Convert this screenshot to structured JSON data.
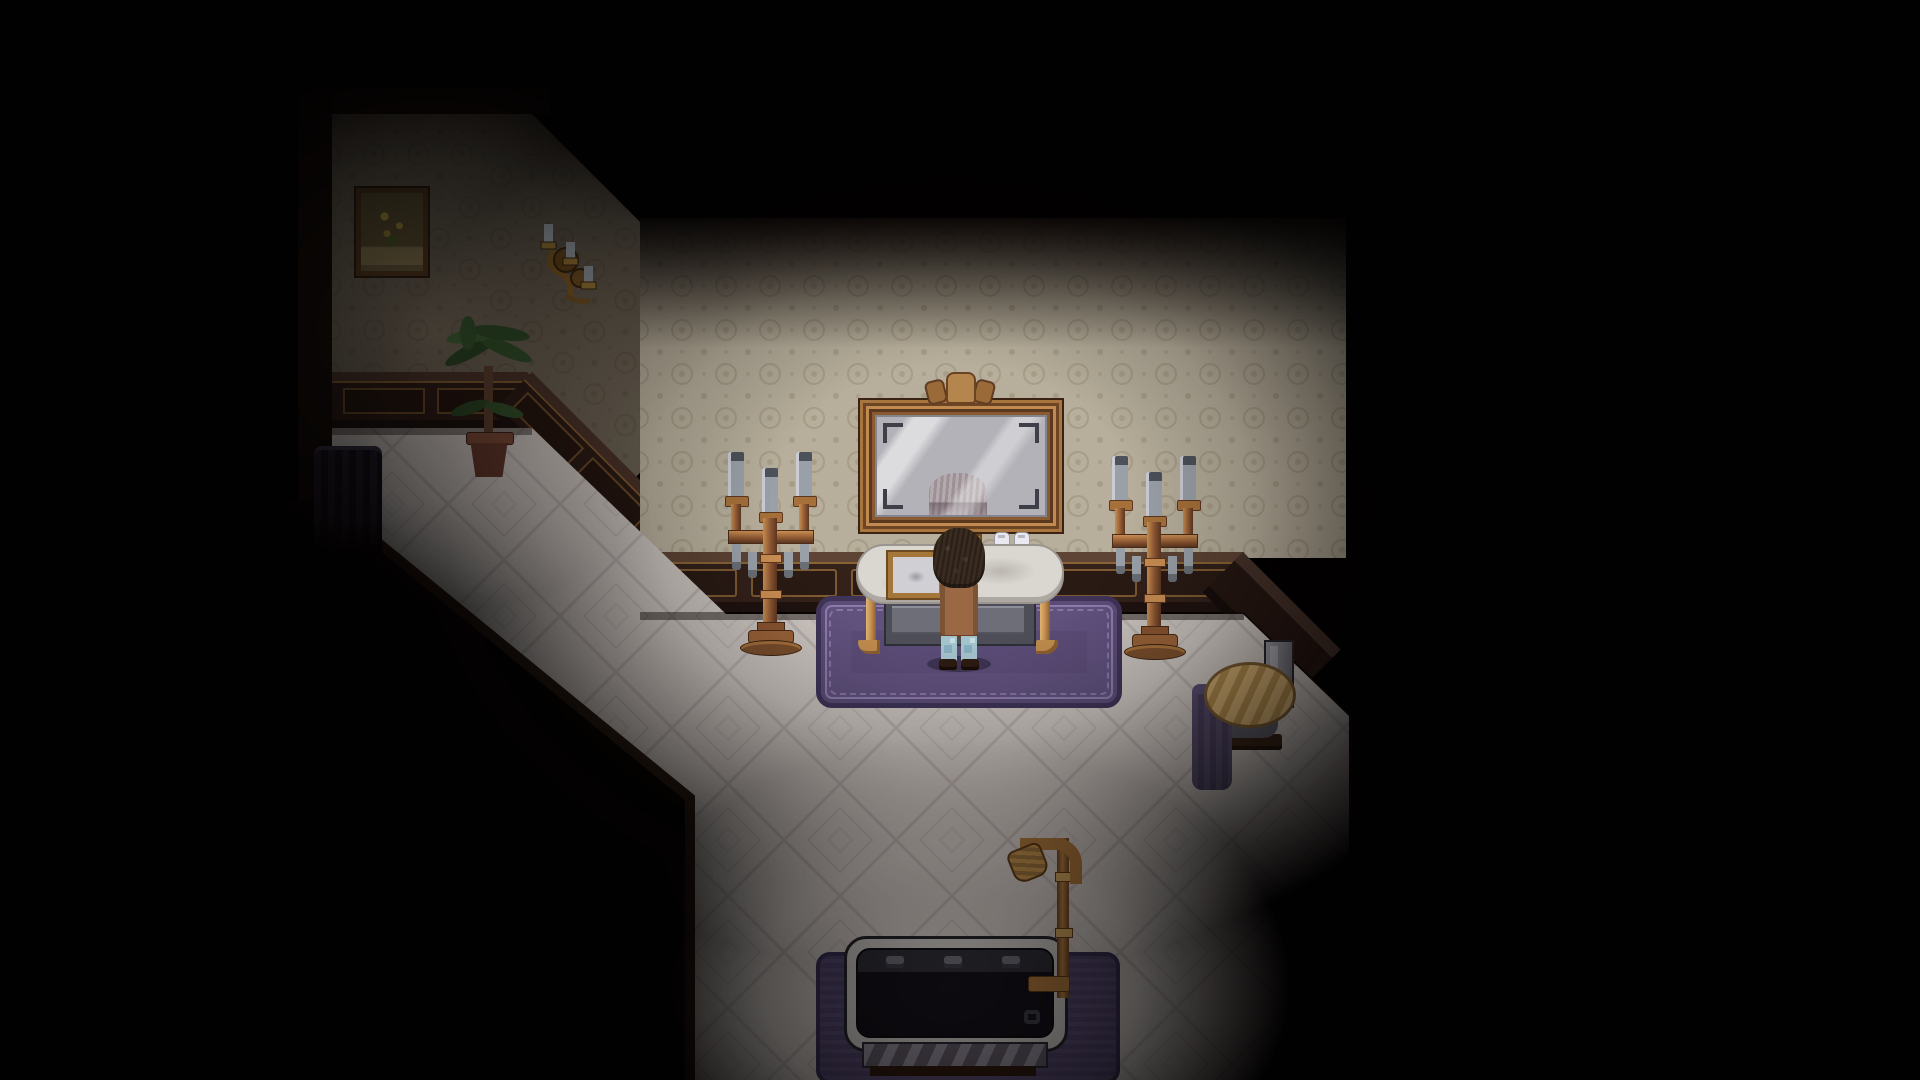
{
  "scene": {
    "kind": "pixel-art game interior",
    "room": "dim victorian bathroom with vanity alcove",
    "lighting": "dark vignette with light pool over vanity, dimmer pools over corridor and bathtub"
  },
  "palette": {
    "background": "#020101",
    "wallpaper": "#b7ae9b",
    "wallpaper_motif": "#a69d87",
    "wainscot_wood": "#33211a",
    "wainscot_trim": "#8a6436",
    "floor_tile": "#cbc4bf",
    "floor_line": "#a89f9f",
    "rug_field": "#5b4c77",
    "rug_border": "#3f3458",
    "rug_ornament": "#8d7cab",
    "copper": "#8a5531",
    "copper_highlight": "#c98e52",
    "gold": "#b98c4a",
    "marble": "#dad6d0",
    "candle_wax": "#9aa0a8",
    "tub_rim": "#c4c1bd",
    "tub_interior": "#131118",
    "bath_mat": "#4e4168",
    "towel": "#49405f",
    "hair": "#3a2b20",
    "shirt": "#9a6845",
    "jeans": "#a3c3cd"
  },
  "objects": {
    "character": {
      "label": "Player character standing at the vanity, seen from behind"
    },
    "mirror": {
      "label": "Ornate copper-framed wall mirror"
    },
    "ghost": {
      "label": "Pale reflection of a head in the mirror glass"
    },
    "vanity": {
      "label": "Marble-top vanity washstand with gold legs"
    },
    "tray": {
      "label": "Gold-framed tray on the counter"
    },
    "bottles": {
      "label": "Two white bottles with purple labels"
    },
    "candelabra_left": {
      "label": "Copper floor candelabra with grey candles (left)"
    },
    "candelabra_right": {
      "label": "Copper floor candelabra with grey candles (right)"
    },
    "rug": {
      "label": "Purple ornamental rug"
    },
    "bathtub": {
      "label": "Bathtub with dark interior and three fixtures"
    },
    "shower_pipe": {
      "label": "Gold shower pipe with curved head"
    },
    "bath_mat": {
      "label": "Purple mat under the bathtub"
    },
    "stool": {
      "label": "Round wooden stool with basin"
    },
    "towel": {
      "label": "Purple towel draped beside the stool"
    },
    "canister": {
      "label": "Metal canister behind the stool"
    },
    "plant": {
      "label": "Potted palm plant in the corridor"
    },
    "picture": {
      "label": "Framed floral still-life painting"
    },
    "sconce": {
      "label": "Gold wall sconce with pale candles"
    },
    "screen": {
      "label": "Dark folding screen at the corridor end"
    },
    "walls": {
      "label": "Damask wallpaper with dark wood wainscoting"
    },
    "floor": {
      "label": "Pale diamond-tiled floor"
    }
  }
}
